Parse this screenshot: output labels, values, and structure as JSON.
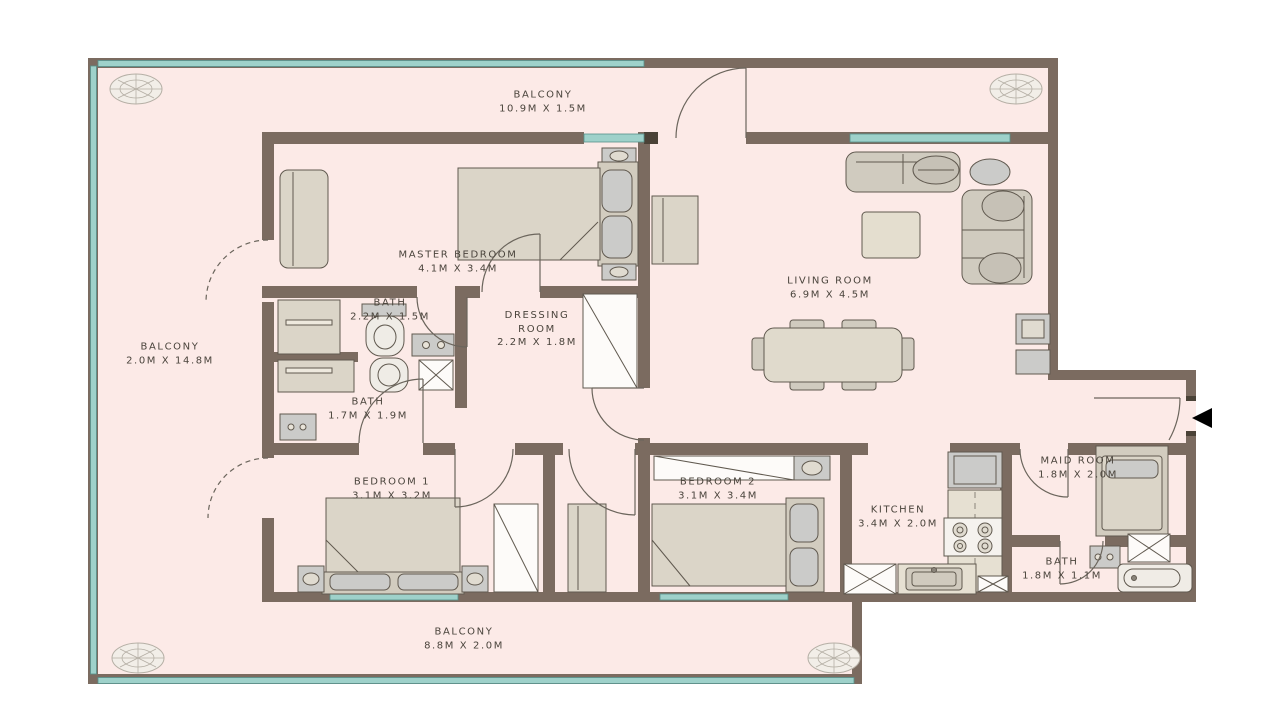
{
  "plan": {
    "type": "apartment-floor-plan",
    "rooms": {
      "balcony_top": {
        "name": "BALCONY",
        "size": "10.9M x 1.5M"
      },
      "balcony_left": {
        "name": "BALCONY",
        "size": "2.0M x 14.8M"
      },
      "balcony_bottom": {
        "name": "BALCONY",
        "size": "8.8M x 2.0M"
      },
      "master_bedroom": {
        "name": "MASTER BEDROOM",
        "size": "4.1M x 3.4M"
      },
      "bath_master": {
        "name": "BATH",
        "size": "2.2M x 1.5M"
      },
      "dressing_room": {
        "name": "DRESSING ROOM",
        "size": "2.2M x 1.8M"
      },
      "bath_2": {
        "name": "BATH",
        "size": "1.7M x 1.9M"
      },
      "living_room": {
        "name": "LIVING ROOM",
        "size": "6.9M x 4.5M"
      },
      "bedroom_1": {
        "name": "BEDROOM 1",
        "size": "3.1M x 3.2M"
      },
      "bedroom_2": {
        "name": "BEDROOM 2",
        "size": "3.1M x 3.4M"
      },
      "kitchen": {
        "name": "KITCHEN",
        "size": "3.4M x 2.0M"
      },
      "maid_room": {
        "name": "MAID ROOM",
        "size": "1.8M x 2.0M"
      },
      "bath_maid": {
        "name": "BATH",
        "size": "1.8M x 1.1M"
      }
    },
    "colors": {
      "wall": "#7b6b60",
      "floor": "#fceae7",
      "glass": "#9ed1ca",
      "furniture_beige": "#dbd5c8",
      "furniture_gray": "#cbcbc9",
      "text": "#4a443c"
    },
    "icons": {
      "entrance_arrow": "left-pointing-triangle",
      "corner_plant": "decorative-plant-top-view"
    }
  }
}
